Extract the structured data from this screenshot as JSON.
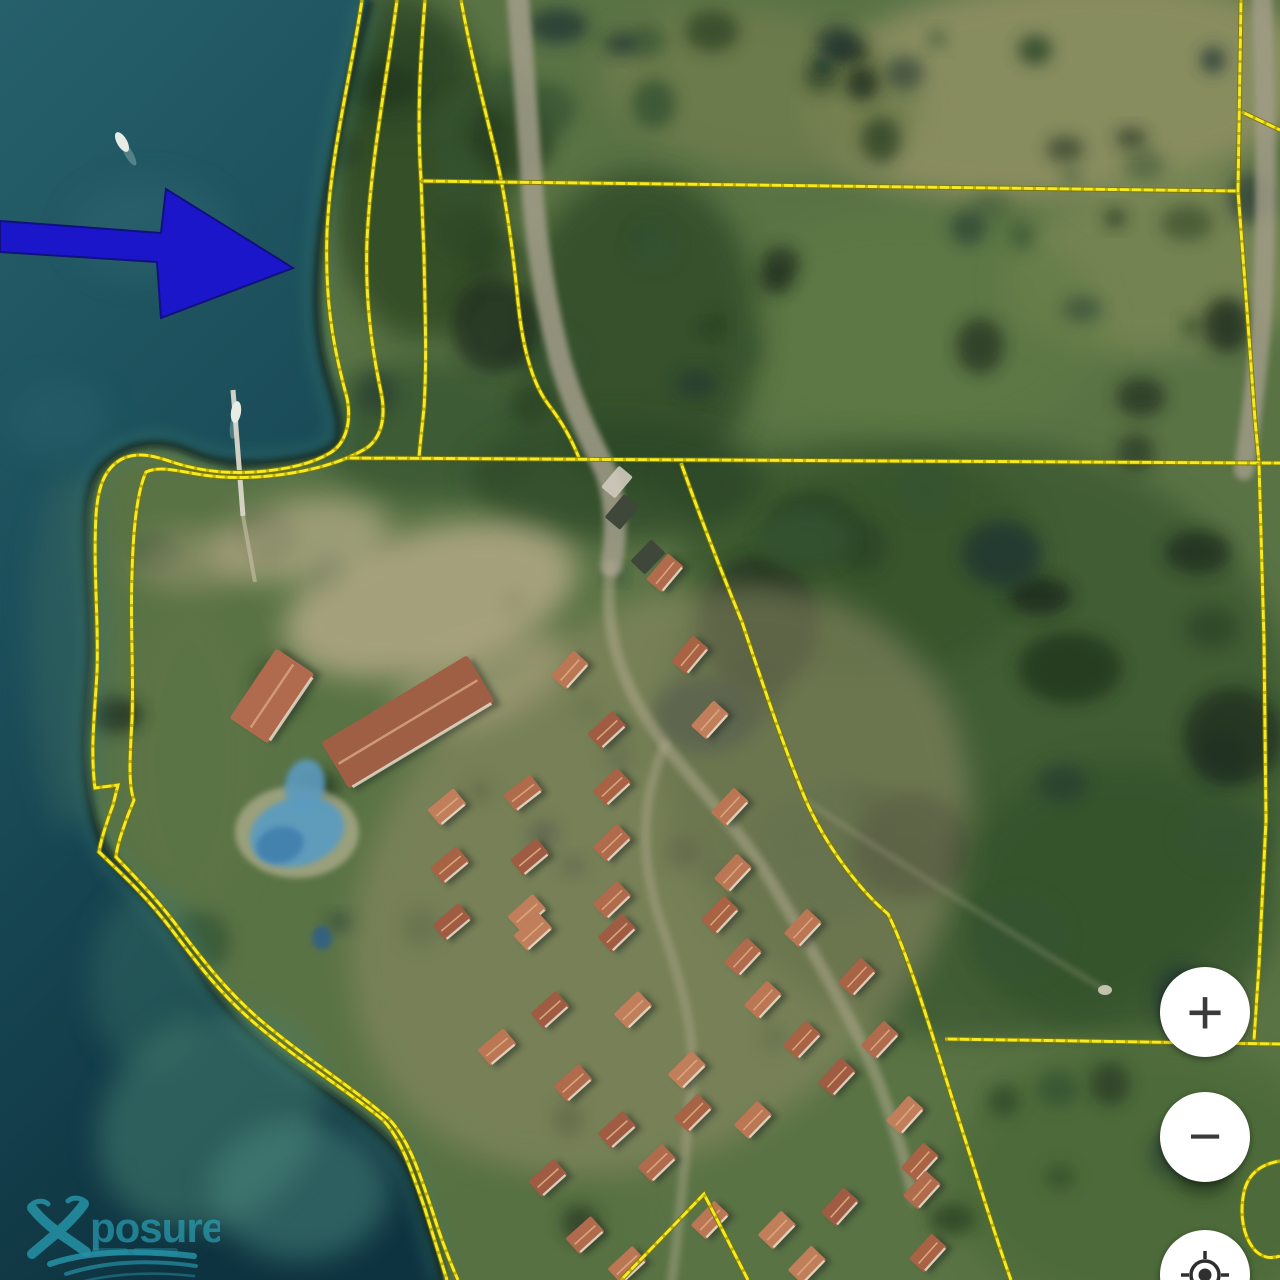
{
  "controls": {
    "zoom_in_label": "+",
    "zoom_out_label": "−",
    "locate_icon": "gps-crosshair"
  },
  "watermark": {
    "text": "posure",
    "color": "#2ba8bf"
  },
  "map": {
    "colors": {
      "water_top": "#26606b",
      "water_mid": "#1a4d59",
      "water_deep": "#0e3340",
      "land_base": "#5a7345",
      "parcel_line": "#f6eb20",
      "parcel_casing": "#7e7400",
      "arrow_fill": "#1c16cb",
      "arrow_stroke": "#11107f",
      "road": "#a39e8a",
      "roof_variants": [
        "#b06a4c",
        "#a86244",
        "#bb7654",
        "#c07f5a",
        "#9f5c42"
      ],
      "pool": "#5c9bbf",
      "pool_deep": "#3f7fae"
    },
    "coast_path": "M370,0 C352,70 335,140 324,210 C316,265 312,320 326,372 C336,408 344,428 336,443 C324,456 300,460 268,463 C240,465 212,462 190,452 C168,442 143,441 122,452 C100,463 88,480 86,515 C84,565 92,615 89,665 C86,710 80,745 88,790 C92,818 99,842 114,862 C136,888 165,915 193,962 C216,1000 244,1030 283,1060 C330,1096 372,1120 398,1152 C416,1175 424,1215 436,1252 L443,1280",
    "water_path": "M0,0 L370,0 C352,70 335,140 324,210 C316,265 312,320 326,372 C336,408 344,428 336,443 C324,456 300,460 268,463 C240,465 212,462 190,452 C168,442 143,441 122,452 C100,463 88,480 86,515 C84,565 92,615 89,665 C86,710 80,745 88,790 C92,818 99,842 114,862 C136,888 165,915 193,962 C216,1000 244,1030 283,1060 C330,1096 372,1120 398,1152 C416,1175 424,1215 436,1252 L443,1280 L0,1280 Z",
    "parcel_lines": [
      "M362,0 C351,75 331,150 327,232 C325,295 331,340 347,398 C352,424 345,444 330,453 C310,465 283,470 255,472 C225,474 196,470 172,462 C152,455 137,452 122,459 C105,468 98,486 96,515 C93,570 99,625 97,672 C95,712 90,748 95,788 L118,785 L113,805 C106,824 101,840 99,852 C120,872 147,897 172,930 C196,962 222,996 258,1026 C300,1062 350,1092 383,1120 C402,1140 412,1172 424,1206 C432,1232 440,1258 447,1280",
      "M397,0 C387,78 371,158 367,240 C365,298 371,345 381,392 C386,416 382,436 368,447 C350,459 322,468 292,473 C262,478 230,479 203,475 C181,472 161,465 146,472 C137,492 133,530 132,575 C130,625 134,675 132,720 C130,755 128,785 134,800 L128,815 C122,832 117,845 116,857 C134,876 158,900 180,930 C204,962 230,995 265,1024 C308,1060 356,1090 390,1120 C410,1142 420,1175 432,1210 C440,1236 450,1262 458,1280",
      "M425,0 C420,60 417,120 421,180 L424,255 C425,310 427,360 424,408 C422,428 420,444 419,458",
      "M461,0 C470,50 482,98 494,147 C506,197 513,250 518,302 C523,352 533,384 548,404 C562,422 572,440 579,458",
      "M421,181 L1239,191",
      "M1241,0 L1238,191 L1247,310 L1255,420 L1259,462",
      "M1242,112 L1280,130",
      "M347,458 L1259,463 L1280,463",
      "M1259,463 L1264,640 L1266,820 L1259,965 L1254,1040",
      "M945,1039 L1280,1044",
      "M681,463 C703,525 726,583 742,622 C762,682 782,742 804,796 C826,848 862,892 888,914 C912,962 940,1062 966,1142 C986,1206 1000,1250 1011,1280",
      "M621,1280 L704,1194 L748,1280",
      "M1280,1161 C1261,1164 1248,1174 1244,1192 C1239,1216 1244,1236 1253,1248 C1261,1258 1271,1259 1280,1256"
    ],
    "roads": [
      {
        "d": "M518,0 C524,70 528,130 532,185 C536,245 546,305 560,360 C574,410 592,442 606,472 C615,498 618,532 611,566",
        "w": 22,
        "o": 0.85
      },
      {
        "d": "M1262,0 C1266,120 1268,240 1260,340 C1254,400 1248,440 1244,470",
        "w": 20,
        "o": 0.8
      }
    ],
    "resort_paths": [
      {
        "d": "M611,566 C600,640 630,700 665,745 C700,790 740,830 770,880 C800,930 830,980 860,1040 C880,1080 900,1140 915,1200",
        "w": 12,
        "o": 0.5
      },
      {
        "d": "M665,745 C640,800 640,860 660,920 C680,980 700,1040 690,1100 C685,1160 680,1220 672,1280",
        "w": 10,
        "o": 0.42
      },
      {
        "d": "M805,800 C880,850 990,920 1105,990",
        "w": 5,
        "o": 0.3
      }
    ],
    "buildings": [
      [
        665,
        573,
        -50
      ],
      [
        690,
        655,
        -50
      ],
      [
        570,
        670,
        -48
      ],
      [
        710,
        720,
        -48
      ],
      [
        607,
        730,
        -43
      ],
      [
        523,
        793,
        -38
      ],
      [
        612,
        787,
        -43
      ],
      [
        730,
        807,
        -47
      ],
      [
        447,
        807,
        -40
      ],
      [
        530,
        857,
        -40
      ],
      [
        612,
        843,
        -44
      ],
      [
        450,
        865,
        -40
      ],
      [
        733,
        873,
        -47
      ],
      [
        527,
        913,
        -42
      ],
      [
        452,
        922,
        -40
      ],
      [
        612,
        900,
        -44
      ],
      [
        720,
        915,
        -47
      ],
      [
        803,
        928,
        -47
      ],
      [
        533,
        932,
        -42
      ],
      [
        617,
        933,
        -44
      ],
      [
        743,
        957,
        -47
      ],
      [
        857,
        977,
        -47
      ],
      [
        763,
        1000,
        -47
      ],
      [
        633,
        1010,
        -44
      ],
      [
        550,
        1010,
        -42
      ],
      [
        880,
        1040,
        -47
      ],
      [
        802,
        1040,
        -47
      ],
      [
        497,
        1047,
        -40
      ],
      [
        687,
        1070,
        -45
      ],
      [
        837,
        1077,
        -47
      ],
      [
        573,
        1083,
        -42
      ],
      [
        693,
        1113,
        -45
      ],
      [
        753,
        1120,
        -46
      ],
      [
        905,
        1115,
        -48
      ],
      [
        617,
        1130,
        -42
      ],
      [
        657,
        1163,
        -44
      ],
      [
        920,
        1162,
        -48
      ],
      [
        710,
        1220,
        -46
      ],
      [
        777,
        1230,
        -46
      ],
      [
        840,
        1207,
        -48
      ],
      [
        922,
        1190,
        -48
      ],
      [
        928,
        1253,
        -48
      ],
      [
        627,
        1265,
        -43
      ],
      [
        807,
        1265,
        -46
      ],
      [
        548,
        1178,
        -42
      ],
      [
        585,
        1235,
        -42
      ]
    ],
    "building_size": {
      "w": 34,
      "h": 21
    },
    "large_buildings": [
      {
        "x": 408,
        "y": 722,
        "w": 170,
        "h": 54,
        "r": -31,
        "fill": "#9e5f45"
      },
      {
        "x": 272,
        "y": 696,
        "w": 84,
        "h": 46,
        "r": -56,
        "fill": "#b06a4e"
      }
    ],
    "dark_buildings": [
      [
        622,
        512,
        -50
      ],
      [
        648,
        557,
        -46
      ]
    ],
    "light_buildings": [
      [
        617,
        482,
        -50
      ]
    ],
    "pools": [
      {
        "cx": 297,
        "cy": 832,
        "rx": 48,
        "ry": 34,
        "rot": -15,
        "fill": "#5c9bbf",
        "o": 0.95
      },
      {
        "cx": 280,
        "cy": 845,
        "rx": 24,
        "ry": 18,
        "rot": -15,
        "fill": "#3f7fae",
        "o": 0.9
      },
      {
        "cx": 305,
        "cy": 785,
        "rx": 20,
        "ry": 26,
        "rot": 10,
        "fill": "#5c9bbf",
        "o": 0.9
      },
      {
        "cx": 322,
        "cy": 938,
        "rx": 10,
        "ry": 12,
        "rot": 0,
        "fill": "#2e5e8a",
        "o": 0.85
      }
    ],
    "dock": {
      "x1": 233,
      "y1": 390,
      "x2": 243,
      "y2": 516
    },
    "boats": [
      {
        "x": 122,
        "y": 142,
        "rot": -30
      },
      {
        "x": 236,
        "y": 412,
        "rot": 8
      }
    ],
    "white_spot": {
      "x": 1105,
      "y": 990
    },
    "arrow": {
      "points": "0,221 161,233 166,189 293,268 161,318 157,262 0,252"
    }
  }
}
